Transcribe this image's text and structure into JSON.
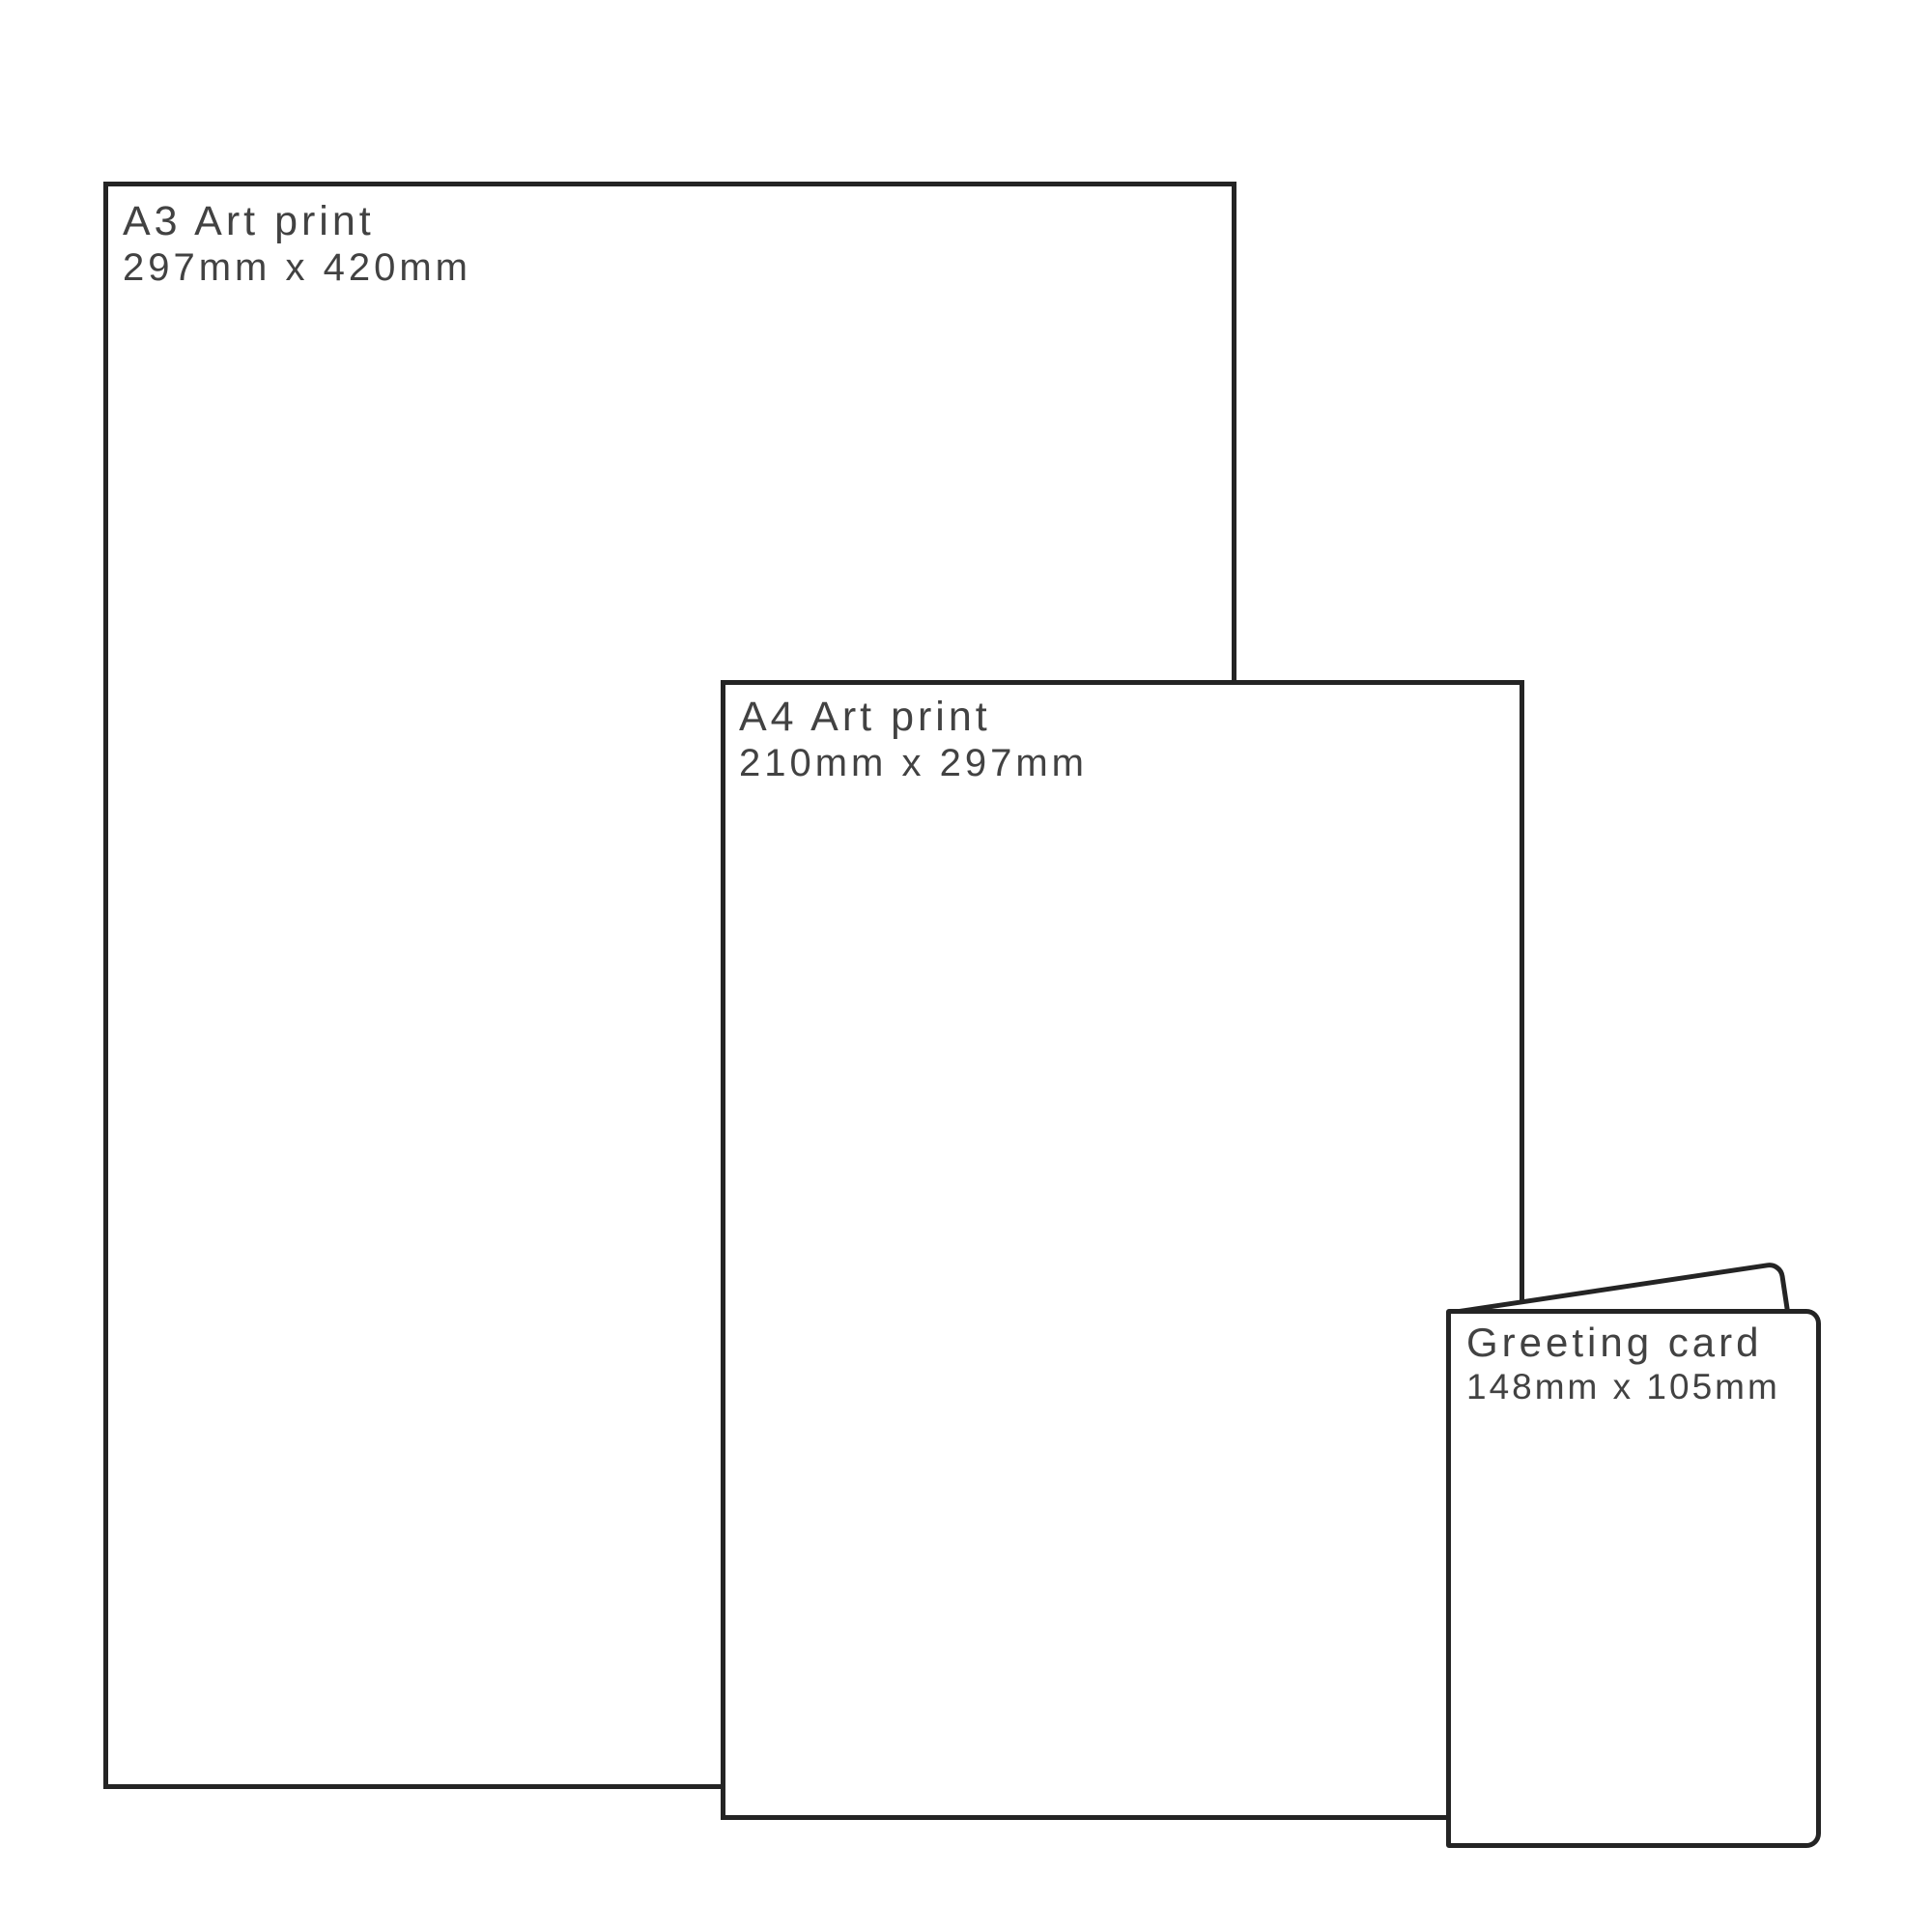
{
  "diagram": {
    "outline_color": "#242424",
    "label_color": "#424242",
    "background_color": "#ffffff",
    "items": [
      {
        "id": "a3-print",
        "title": "A3 Art print",
        "size": "297mm x 420mm"
      },
      {
        "id": "a4-print",
        "title": "A4 Art print",
        "size": "210mm x 297mm"
      },
      {
        "id": "greeting-card",
        "title": "Greeting card",
        "size": "148mm x 105mm"
      }
    ]
  }
}
